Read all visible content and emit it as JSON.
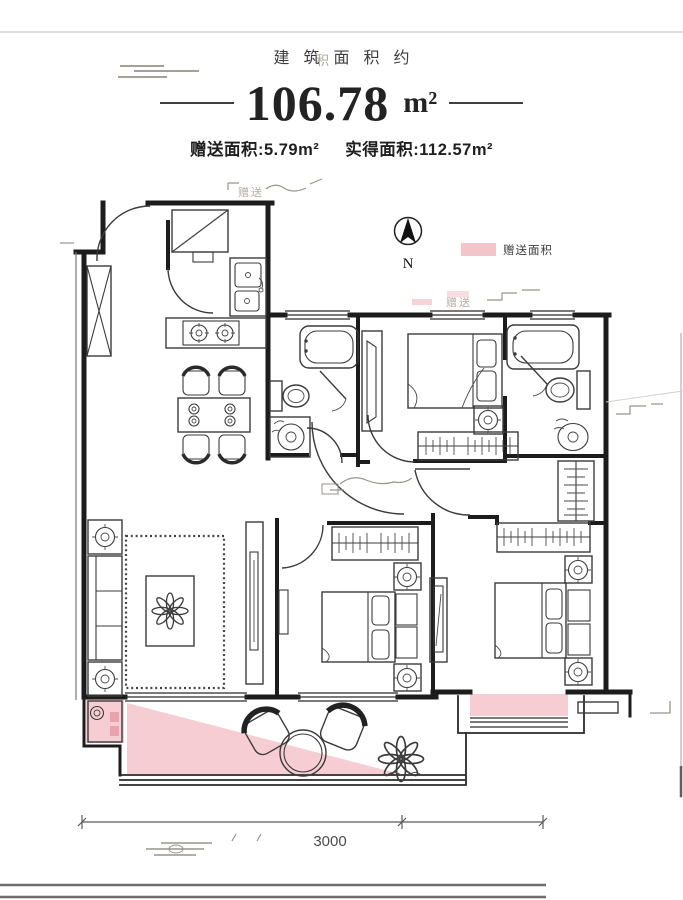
{
  "colors": {
    "gift_pink": "#f6cdd2",
    "legend_pink": "#f3c4c9",
    "accent_pink": "#e9a3ad"
  },
  "header": {
    "watermark_top": "积",
    "area_about_label": "建筑面积约",
    "area_value": "106.78",
    "area_unit": "m²",
    "gift_area": "赠送面积:5.79m²",
    "actual_area": "实得面积:112.57m²"
  },
  "compass": {
    "north": "N"
  },
  "legend": {
    "label": "赠送面积"
  },
  "dimension": {
    "value": "3000"
  },
  "watermarks": {
    "w1": "赠送",
    "w2": "赠送"
  }
}
